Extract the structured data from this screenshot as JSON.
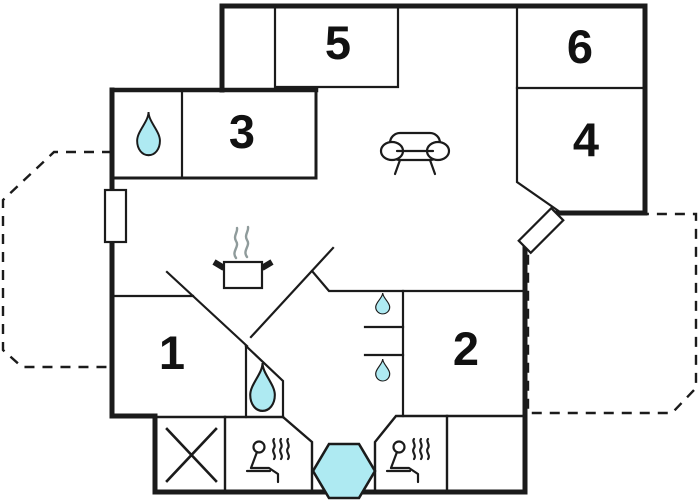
{
  "floorplan": {
    "rooms": [
      {
        "id": "room-1",
        "label": "1"
      },
      {
        "id": "room-2",
        "label": "2"
      },
      {
        "id": "room-3",
        "label": "3"
      },
      {
        "id": "room-4",
        "label": "4"
      },
      {
        "id": "room-5",
        "label": "5"
      },
      {
        "id": "room-6",
        "label": "6"
      }
    ],
    "icons": [
      {
        "name": "water-drop-icon",
        "count": 4
      },
      {
        "name": "sauna-icon",
        "count": 2
      },
      {
        "name": "cooking-pot-icon",
        "count": 1
      },
      {
        "name": "sofa-icon",
        "count": 1
      },
      {
        "name": "hot-tub-icon",
        "count": 1
      },
      {
        "name": "cross-icon",
        "count": 1
      },
      {
        "name": "door-icon",
        "count": 1
      },
      {
        "name": "window-icon",
        "count": 1
      },
      {
        "name": "terrace-area",
        "count": 2
      }
    ],
    "colors": {
      "wall": "#1b1b1b",
      "water_fill": "#aeeaf2",
      "terrace_fill": "#e9f1ef",
      "steam": "#8f9b9b",
      "background": "#ffffff"
    }
  }
}
